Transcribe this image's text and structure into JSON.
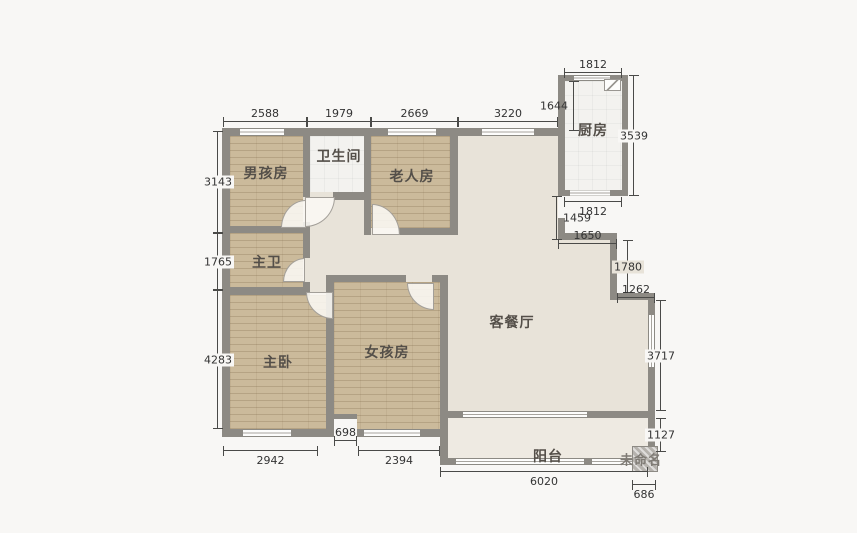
{
  "page": {
    "background": "#f8f7f5"
  },
  "colors": {
    "wall": "#8d8a84",
    "wood_floor": "#cbba9b",
    "living_floor": "#e8e3d9",
    "balcony_floor": "#eeeae2",
    "tile_floor": "#f3f2ef",
    "dimension_text": "#333333"
  },
  "rooms": {
    "boy": "男孩房",
    "bath": "卫生间",
    "elder": "老人房",
    "kitchen": "厨房",
    "master_bath": "主卫",
    "master": "主卧",
    "girl": "女孩房",
    "living": "客餐厅",
    "balcony": "阳台",
    "unnamed": "未命名"
  },
  "dims": {
    "top_boy": "2588",
    "top_bath": "1979",
    "top_elder": "2669",
    "top_living": "3220",
    "kitchen_top": "1812",
    "kitchen_right": "3539",
    "kitchen_bottom": "1812",
    "entry_height": "1644",
    "entry_gap": "1459",
    "entry_wall": "1650",
    "step_v": "1780",
    "step_h": "1262",
    "living_right": "3717",
    "balcony_right": "1127",
    "left_boy": "3143",
    "left_mbath": "1765",
    "left_master": "4283",
    "bottom_master": "2942",
    "notch": "698",
    "bottom_girl": "2394",
    "balcony_bottom": "6020",
    "unnamed_w": "686"
  },
  "icons": {
    "kitchen_vent": "vent-icon",
    "flue_block": "flue-hatch"
  }
}
